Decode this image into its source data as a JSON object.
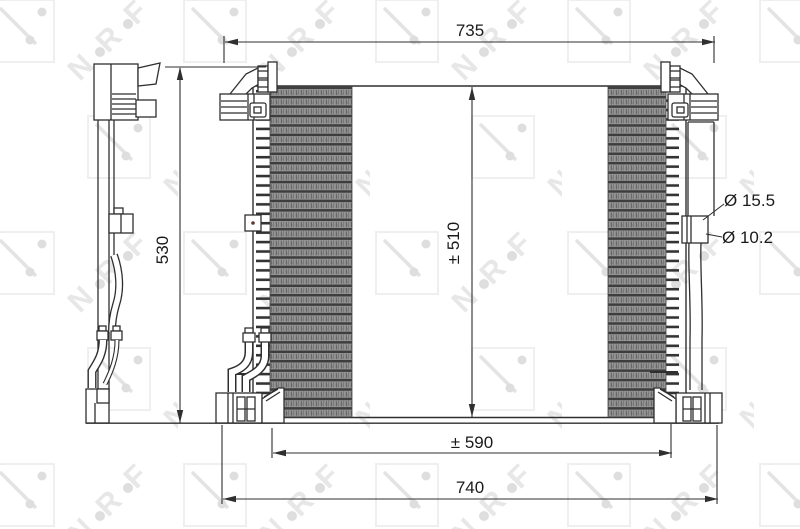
{
  "title": "Condenser technical drawing",
  "watermark": {
    "letter_n": "N",
    "letter_r": "R",
    "letter_f": "F"
  },
  "dimensions": {
    "top_width": "735",
    "left_height": "530",
    "core_height": "± 510",
    "core_width": "± 590",
    "bottom_width": "740",
    "port_large": "Ø 15.5",
    "port_small": "Ø 10.2"
  },
  "colors": {
    "line": "#2f2f2f",
    "text": "#1a1a1a",
    "watermark_light": "#ececec",
    "watermark_mid": "#dedede",
    "fin_dark": "#3d3d3d",
    "fin_mid": "#999999"
  }
}
